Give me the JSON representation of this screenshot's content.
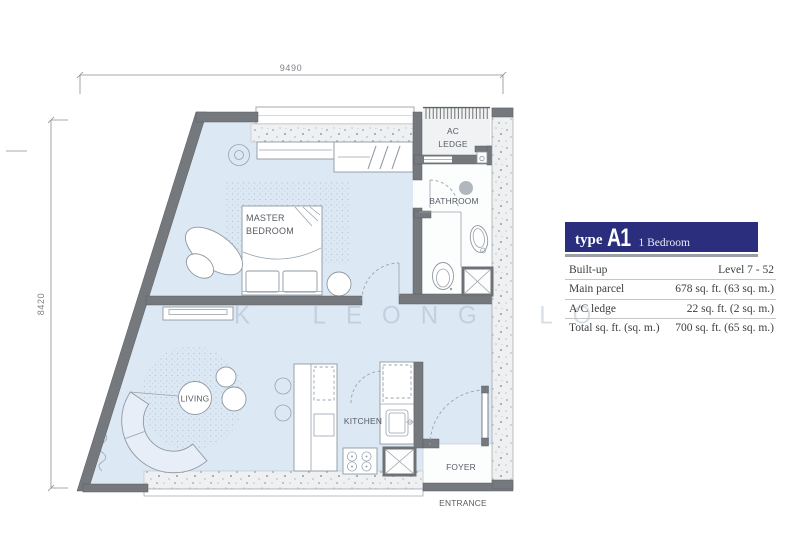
{
  "plan": {
    "dimensions": {
      "top": "9490",
      "left": "8420"
    },
    "watermark": "K LEONG LO",
    "rooms": {
      "master_bedroom": {
        "line1": "MASTER",
        "line2": "BEDROOM"
      },
      "ac_ledge": {
        "line1": "AC",
        "line2": "LEDGE"
      },
      "bathroom": "BATHROOM",
      "living": "LIVING",
      "kitchen": "KITCHEN",
      "foyer": "FOYER",
      "entrance": "ENTRANCE"
    },
    "colors": {
      "floor": "#dce8f4",
      "wall": "#75797d",
      "speckle": "#eef0f2",
      "accent": "#2a2e7c"
    }
  },
  "legend": {
    "header": {
      "type_label": "type",
      "unit_code": "A1",
      "unit_type": "1 Bedroom"
    },
    "rows": [
      {
        "label": "Built-up",
        "value": "Level 7 - 52"
      },
      {
        "label": "Main parcel",
        "value": "678 sq. ft. (63 sq. m.)"
      },
      {
        "label": "A/C ledge",
        "value": "22 sq. ft. (2 sq. m.)"
      },
      {
        "label": "Total sq. ft. (sq. m.)",
        "value": "700 sq. ft. (65 sq. m.)"
      }
    ]
  }
}
